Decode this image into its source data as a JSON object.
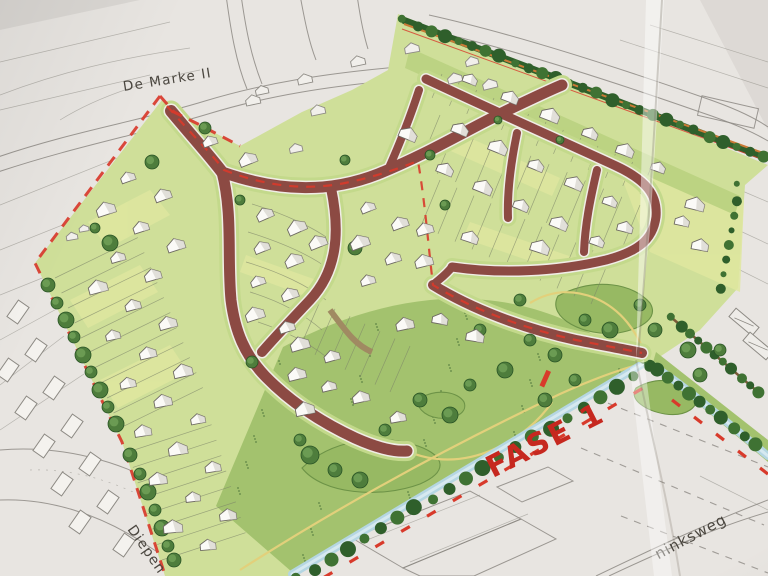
{
  "title": "Photographed urban development site plan",
  "labels": {
    "district": "De Marke II",
    "phase": "FASE 1",
    "street_sw": "Diepen",
    "street_se": "ninksweg"
  },
  "colors": {
    "paper": "#e8e5e1",
    "pencil": "#8d8a84",
    "ink": "#4a463f",
    "road": "#8c4a43",
    "road_edge": "#f0ede6",
    "verge": "#c3d98b",
    "parcel_light": "#cfdf99",
    "parcel_yellow": "#dfe79f",
    "parcel_mid": "#b9d17f",
    "meadow": "#a3c26e",
    "mound": "#97b963",
    "mound_line": "#6d9347",
    "tree_dark": "#2f5f2b",
    "tree_mid": "#4e7d3c",
    "tree_light": "#6f9f55",
    "hedge": "#35682e",
    "water": "#b5d6e2",
    "water_light": "#d6e9f0",
    "path_yellow": "#e2d07b",
    "boundary_red": "#d83a2b",
    "phase_text": "#c6281f",
    "orange_line": "#c97a36",
    "house_fill": "#fbfaf7",
    "house_shade": "#d8d5cf",
    "house_stroke": "#6d6962",
    "avenue_brown": "#7a5a38"
  },
  "map_features": {
    "houses": [
      [
        128,
        178,
        -20
      ],
      [
        163,
        196,
        -20
      ],
      [
        106,
        210,
        -18
      ],
      [
        141,
        228,
        -18
      ],
      [
        176,
        246,
        -18
      ],
      [
        118,
        258,
        -16
      ],
      [
        153,
        276,
        -16
      ],
      [
        98,
        288,
        -15
      ],
      [
        133,
        306,
        -15
      ],
      [
        168,
        324,
        -15
      ],
      [
        113,
        336,
        -13
      ],
      [
        148,
        354,
        -13
      ],
      [
        183,
        372,
        -13
      ],
      [
        128,
        384,
        -11
      ],
      [
        163,
        402,
        -11
      ],
      [
        198,
        420,
        -11
      ],
      [
        143,
        432,
        -9
      ],
      [
        178,
        450,
        -9
      ],
      [
        213,
        468,
        -9
      ],
      [
        158,
        480,
        -7
      ],
      [
        193,
        498,
        -7
      ],
      [
        228,
        516,
        -7
      ],
      [
        173,
        528,
        -5
      ],
      [
        208,
        546,
        -5
      ],
      [
        248,
        160,
        -22
      ],
      [
        210,
        142,
        -20
      ],
      [
        265,
        215,
        -24
      ],
      [
        297,
        228,
        -24
      ],
      [
        262,
        248,
        -22
      ],
      [
        294,
        261,
        -22
      ],
      [
        258,
        282,
        -20
      ],
      [
        290,
        295,
        -20
      ],
      [
        255,
        315,
        -18
      ],
      [
        287,
        328,
        -18
      ],
      [
        318,
        243,
        -22
      ],
      [
        368,
        208,
        -22
      ],
      [
        400,
        224,
        -20
      ],
      [
        360,
        243,
        -20
      ],
      [
        393,
        259,
        -18
      ],
      [
        424,
        262,
        -14
      ],
      [
        368,
        281,
        -16
      ],
      [
        425,
        230,
        -16
      ],
      [
        300,
        345,
        -16
      ],
      [
        332,
        357,
        -16
      ],
      [
        297,
        375,
        -14
      ],
      [
        329,
        387,
        -14
      ],
      [
        361,
        398,
        -12
      ],
      [
        305,
        410,
        -12
      ],
      [
        398,
        418,
        -10
      ],
      [
        405,
        325,
        -12
      ],
      [
        470,
        80,
        21
      ],
      [
        510,
        98,
        21
      ],
      [
        550,
        116,
        21
      ],
      [
        590,
        134,
        21
      ],
      [
        625,
        151,
        20
      ],
      [
        658,
        168,
        19
      ],
      [
        460,
        130,
        22
      ],
      [
        498,
        148,
        22
      ],
      [
        536,
        166,
        22
      ],
      [
        574,
        184,
        22
      ],
      [
        610,
        202,
        20
      ],
      [
        445,
        170,
        22
      ],
      [
        483,
        188,
        22
      ],
      [
        521,
        206,
        22
      ],
      [
        559,
        224,
        22
      ],
      [
        597,
        242,
        20
      ],
      [
        470,
        238,
        18
      ],
      [
        540,
        248,
        18
      ],
      [
        625,
        228,
        14
      ],
      [
        408,
        135,
        22
      ],
      [
        682,
        222,
        12
      ],
      [
        700,
        246,
        10
      ],
      [
        695,
        205,
        14
      ],
      [
        440,
        320,
        10
      ],
      [
        475,
        337,
        9
      ]
    ],
    "pencil_houses": [
      [
        72,
        237,
        -10,
        0.7
      ],
      [
        84,
        229,
        -10,
        0.6
      ],
      [
        253,
        101,
        -12,
        0.9
      ],
      [
        262,
        91,
        -12,
        0.8
      ],
      [
        305,
        80,
        -12,
        0.9
      ],
      [
        318,
        111,
        -12,
        0.9
      ],
      [
        358,
        62,
        -12,
        0.9
      ],
      [
        412,
        49,
        -10,
        0.9
      ],
      [
        455,
        79,
        -14,
        0.9
      ],
      [
        472,
        62,
        -14,
        0.8
      ],
      [
        490,
        85,
        -14,
        0.9
      ],
      [
        296,
        149,
        -12,
        0.8
      ]
    ],
    "pencil_rects": [
      [
        18,
        312
      ],
      [
        36,
        350
      ],
      [
        54,
        388
      ],
      [
        72,
        426
      ],
      [
        90,
        464
      ],
      [
        108,
        502
      ],
      [
        8,
        370
      ],
      [
        26,
        408
      ],
      [
        44,
        446
      ],
      [
        62,
        484
      ],
      [
        80,
        522
      ],
      [
        124,
        545
      ]
    ],
    "farm_rects": [
      [
        744,
        322
      ],
      [
        758,
        346
      ]
    ],
    "trees": [
      [
        48,
        285,
        7
      ],
      [
        57,
        303,
        6
      ],
      [
        66,
        320,
        8
      ],
      [
        74,
        337,
        6
      ],
      [
        83,
        355,
        8
      ],
      [
        91,
        372,
        6
      ],
      [
        100,
        390,
        8
      ],
      [
        108,
        407,
        6
      ],
      [
        116,
        424,
        8
      ],
      [
        130,
        455,
        7
      ],
      [
        140,
        474,
        6
      ],
      [
        148,
        492,
        8
      ],
      [
        155,
        510,
        6
      ],
      [
        162,
        528,
        8
      ],
      [
        168,
        546,
        6
      ],
      [
        174,
        560,
        7
      ],
      [
        110,
        243,
        8
      ],
      [
        95,
        228,
        5
      ],
      [
        152,
        162,
        7
      ],
      [
        205,
        128,
        6
      ],
      [
        345,
        160,
        5
      ],
      [
        355,
        248,
        7
      ],
      [
        445,
        205,
        5
      ],
      [
        310,
        455,
        9
      ],
      [
        335,
        470,
        7
      ],
      [
        360,
        480,
        8
      ],
      [
        300,
        440,
        6
      ],
      [
        385,
        430,
        6
      ],
      [
        420,
        400,
        7
      ],
      [
        450,
        415,
        8
      ],
      [
        470,
        385,
        6
      ],
      [
        505,
        370,
        8
      ],
      [
        530,
        340,
        6
      ],
      [
        555,
        355,
        7
      ],
      [
        585,
        320,
        6
      ],
      [
        610,
        330,
        8
      ],
      [
        640,
        305,
        6
      ],
      [
        655,
        330,
        7
      ],
      [
        688,
        350,
        8
      ],
      [
        700,
        375,
        7
      ],
      [
        720,
        350,
        6
      ],
      [
        520,
        300,
        6
      ],
      [
        480,
        330,
        6
      ],
      [
        545,
        400,
        7
      ],
      [
        575,
        380,
        6
      ],
      [
        252,
        362,
        6
      ],
      [
        240,
        200,
        5
      ],
      [
        430,
        155,
        5
      ],
      [
        498,
        120,
        4
      ],
      [
        560,
        140,
        4
      ]
    ]
  }
}
